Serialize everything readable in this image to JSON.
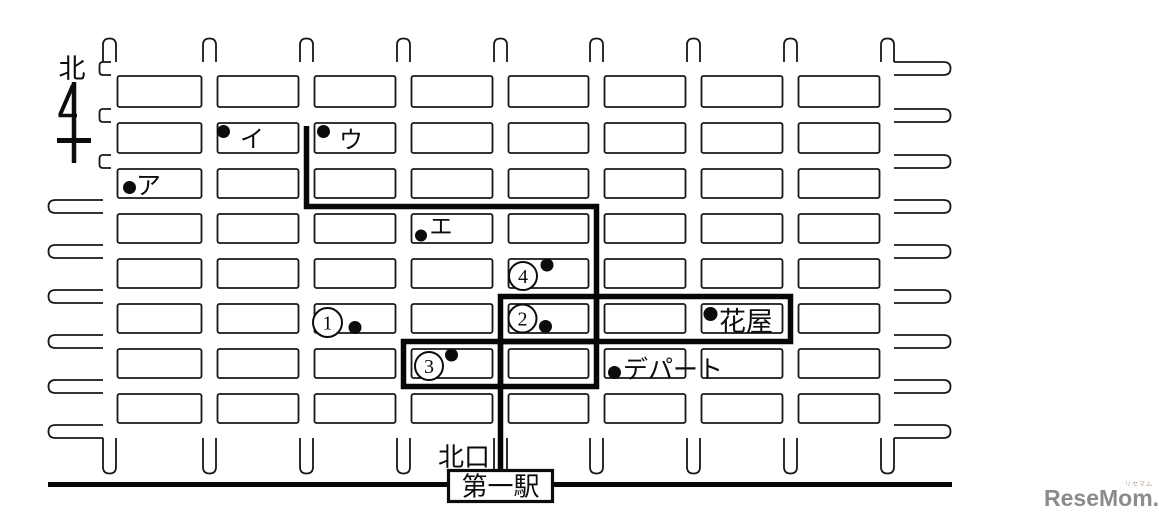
{
  "page": {
    "background": "#ffffff",
    "ink": "#171717"
  },
  "map": {
    "north": {
      "label": "北"
    },
    "katakana_points": [
      {
        "label": "ア"
      },
      {
        "label": "イ"
      },
      {
        "label": "ウ"
      },
      {
        "label": "エ"
      }
    ],
    "numbered_points": [
      {
        "label": "1"
      },
      {
        "label": "2"
      },
      {
        "label": "3"
      },
      {
        "label": "4"
      }
    ],
    "places": {
      "flower_shop": "花屋",
      "department_store": "デパート",
      "north_exit": "北口",
      "station": "第一駅"
    }
  },
  "watermark": {
    "text": "ReseMom.",
    "ruby": "リセマム",
    "color": "#8c8c8c"
  }
}
